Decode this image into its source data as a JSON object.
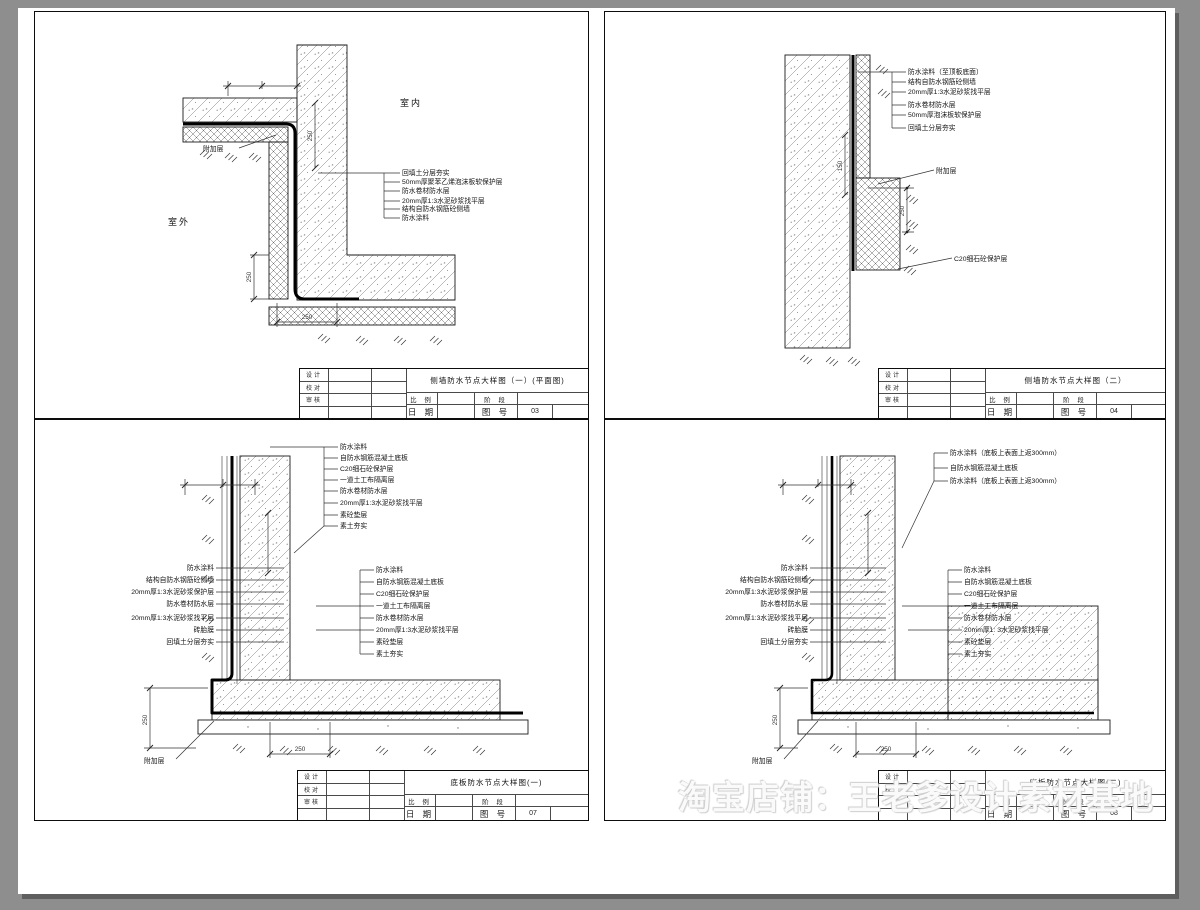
{
  "watermark": "淘宝店铺：王老爹设计素材基地",
  "titleblock_labels": {
    "design": "设计",
    "proof": "校对",
    "review": "审核",
    "scale": "比 例",
    "stage": "阶 段",
    "date": "日 期",
    "fig_no": "图 号"
  },
  "panels": {
    "p1": {
      "title": "侧墙防水节点大样图（一）(平面图)",
      "fig_no": "03",
      "room_in": "室内",
      "room_out": "室外",
      "fujia": "附加层",
      "annotations": [
        "回填土分层夯实",
        "50mm厚聚苯乙烯泡沫板软保护层",
        "防水卷材防水层",
        "20mm厚1:3水泥砂浆找平层",
        "结构自防水钢筋砼侧墙",
        "防水涂料"
      ],
      "dims": {
        "wall": "250",
        "corner_v": "250",
        "corner_h": "250"
      }
    },
    "p2": {
      "title": "侧墙防水节点大样图（二）",
      "fig_no": "04",
      "fujia": "附加层",
      "c20_label": "C20细石砼保护层",
      "annotations": [
        "防水涂料（至顶板底面）",
        "结构自防水钢筋砼侧墙",
        "20mm厚1:3水泥砂浆找平层",
        "防水卷材防水层",
        "50mm厚泡沫板软保护层",
        "回填土分层夯实"
      ],
      "dims": {
        "upper": "150",
        "lower": "250"
      }
    },
    "p3": {
      "title": "底板防水节点大样图(一)",
      "fig_no": "07",
      "fujia": "附加层",
      "top_annotations": [
        "防水涂料",
        "自防水钢筋混凝土底板",
        "C20细石砼保护层",
        "一道土工布隔离层",
        "防水卷材防水层",
        "20mm厚1:3水泥砂浆找平层",
        "素砼垫层",
        "素土夯实"
      ],
      "left_annotations": [
        "防水涂料",
        "结构自防水钢筋砼侧墙",
        "20mm厚1:3水泥砂浆保护层",
        "防水卷材防水层",
        "20mm厚1:3水泥砂浆找平层",
        "砖胎膜",
        "回填土分层夯实"
      ],
      "right_annotations": [
        "防水涂料",
        "自防水钢筋混凝土底板",
        "C20细石砼保护层",
        "一道土工布隔离层",
        "防水卷材防水层",
        "20mm厚1:3水泥砂浆找平层",
        "素砼垫层",
        "素土夯实"
      ],
      "dims": {
        "v": "250",
        "h": "250"
      }
    },
    "p4": {
      "title": "底板防水节点大样图(二)",
      "fig_no": "08",
      "fujia": "附加层",
      "top_annotations": [
        "防水涂料（底板上表面上返300mm）",
        "自防水钢筋混凝土底板",
        "防水涂料（底板上表面上返300mm）"
      ],
      "left_annotations": [
        "防水涂料",
        "结构自防水钢筋砼侧墙",
        "20mm厚1:3水泥砂浆保护层",
        "防水卷材防水层",
        "20mm厚1:3水泥砂浆找平层",
        "砖胎膜",
        "回填土分层夯实"
      ],
      "right_annotations": [
        "防水涂料",
        "自防水钢筋混凝土底板",
        "C20细石砼保护层",
        "一道土工布隔离层",
        "防水卷材防水层",
        "20mm厚1: 3水泥砂浆找平层",
        "素砼垫层",
        "素土夯实"
      ],
      "dims": {
        "v": "250",
        "h": "250"
      }
    }
  }
}
